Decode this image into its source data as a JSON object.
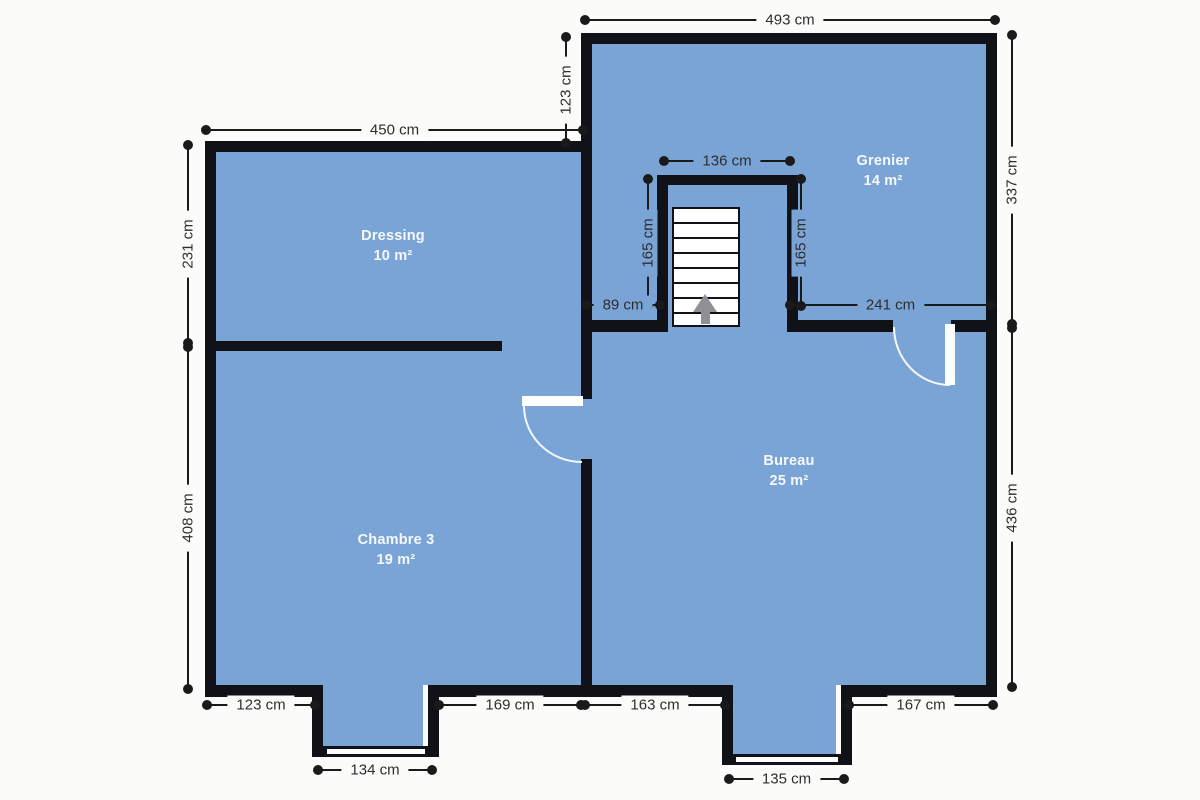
{
  "colors": {
    "room_fill": "#7aa4d5",
    "wall": "#111118",
    "dim_line": "#1a1a1a",
    "dim_text": "#2e2e2e",
    "room_text": "#f5f9ff",
    "canvas_bg": "#fbfbfa",
    "door": "#ffffff",
    "stair_arrow": "#8f9096"
  },
  "rooms": {
    "dressing": {
      "name": "Dressing",
      "area": "10 m²"
    },
    "chambre3": {
      "name": "Chambre 3",
      "area": "19 m²"
    },
    "grenier": {
      "name": "Grenier",
      "area": "14 m²"
    },
    "bureau": {
      "name": "Bureau",
      "area": "25 m²"
    }
  },
  "dimensions": {
    "top_total": "493 cm",
    "top_inset": "123 cm",
    "dressing_top": "450 cm",
    "left_upper": "231 cm",
    "left_lower": "408 cm",
    "right_upper": "337 cm",
    "right_lower": "436 cm",
    "stair_width": "136 cm",
    "stair_left": "165 cm",
    "stair_right": "165 cm",
    "landing_left": "89 cm",
    "landing_right": "241 cm",
    "bottom_1": "123 cm",
    "bottom_2": "169 cm",
    "bottom_3": "163 cm",
    "bottom_4": "167 cm",
    "bay1_window": "134 cm",
    "bay2_window": "135 cm"
  },
  "icons": {
    "stairs_up_arrow": "up-arrow"
  }
}
